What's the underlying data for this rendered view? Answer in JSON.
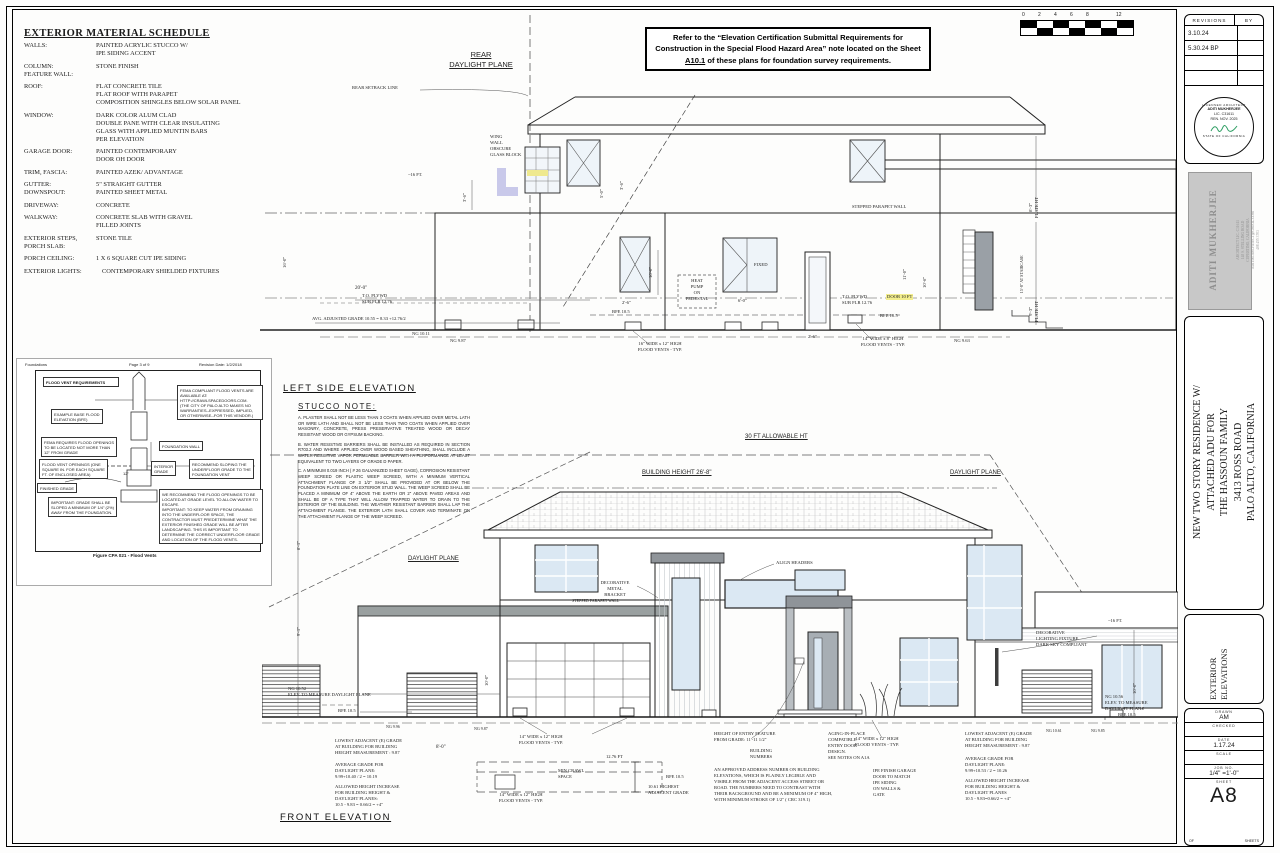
{
  "material_schedule": {
    "title": "EXTERIOR MATERIAL SCHEDULE",
    "items": [
      {
        "label": "WALLS:",
        "value": "PAINTED ACRYLIC STUCCO W/\nIPE SIDING ACCENT"
      },
      {
        "label": "COLUMN:\nFEATURE WALL:",
        "value": "STONE FINISH"
      },
      {
        "label": "ROOF:",
        "value": "FLAT CONCRETE TILE\nFLAT ROOF WITH PARAPET\nCOMPOSITION SHINGLES BELOW SOLAR PANEL"
      },
      {
        "label": "WINDOW:",
        "value": "DARK COLOR ALUM CLAD\nDOUBLE PANE WITH CLEAR INSULATING\nGLASS WITH APPLIED MUNTIN BARS\nPER ELEVATION"
      },
      {
        "label": "GARAGE DOOR:",
        "value": "PAINTED CONTEMPORARY\nDOOR OH DOOR"
      },
      {
        "label": "TRIM, FASCIA:",
        "value": "PAINTED AZEK/ ADVANTAGE"
      },
      {
        "label": "GUTTER:\nDOWNSPOUT:",
        "value": "5\" STRAIGHT GUTTER\nPAINTED SHEET METAL"
      },
      {
        "label": "DRIVEWAY:",
        "value": "CONCRETE"
      },
      {
        "label": "WALKWAY:",
        "value": "CONCRETE SLAB WITH GRAVEL\nFILLED JOINTS"
      },
      {
        "label": "EXTERIOR STEPS,\nPORCH SLAB:",
        "value": "STONE TILE"
      },
      {
        "label": "PORCH CEILING:",
        "value": "1 X 6 SQUARE CUT IPE SIDING"
      },
      {
        "label": "EXTERIOR LIGHTS:",
        "value": "CONTEMPORARY  SHIELDED FIXTURES"
      }
    ]
  },
  "flood_note_box": {
    "text_pre": "Refer to the “Elevation Certification Submittal Requirements for Construction in the Special Flood Hazard Area” note located on the Sheet",
    "sheet_ref": "A10.1",
    "text_post": "of these plans for foundation survey requirements."
  },
  "scale_bar": {
    "ticks": [
      "0",
      "2",
      "4",
      "6",
      "8",
      "12"
    ]
  },
  "left_elevation": {
    "title": "LEFT SIDE ELEVATION",
    "labels": {
      "rear_daylight_plane": "REAR\nDAYLIGHT PLANE",
      "rear_setback_line": "REAR SETBACK LINE",
      "wing_wall": "WING\nWALL\nOBSCURE\nGLASS BLOCK",
      "ht_16": "~16 FT.",
      "dim_3_6_a": "3'-6\"",
      "dim_5_0": "5'-0\"",
      "dim_3_6_b": "3'-6\"",
      "dim_16_0": "16'-0\"",
      "dim_10_0": "10'-0\"",
      "dim_20_0": "20'-0\"",
      "top_plywd_left": "T.O. PLYWD\nSUB FLR 12.76",
      "avg_grade": "AVG. ADJUSTED GRADE 10.55 = 8.33 +12.76/2",
      "ng_1011": "NG 10.11",
      "ng_987": "NG 9.87",
      "heat_pump": "HEAT\nPUMP\nON\nPEDESTAL",
      "fixed": "FIXED",
      "bfe_left": "BFE  10.5",
      "vents_16": "16\" WIDE x 12\" HIGH\nFLOOD VENTS - TYP.",
      "dim_2_6_a": "2'-6\"",
      "dim_6_0": "6'-0\"",
      "dim_2_6_b": "2'-6\"",
      "stepped_parapet": "STEPPED PARAPET WALL",
      "top_plywd_right": "T.O. PLYWD\nSUB FLR 12.76",
      "door_hl": "DOOR 10 FT",
      "bfe_right": "BFE  10.5",
      "vents_14": "14\" WIDE x 8\" HIGH\nFLOOD VENTS - TYP.",
      "ng_963": "NG 9.63",
      "dim_11_0": "11'-0\"",
      "dim_10_6": "10'-6\"",
      "dim_15_8": "15'-8\" AT STAIRCASE",
      "plate_a": "8'-3\"\nPLATE HT",
      "plate_b": "9'-3\"\nPLATE HT"
    }
  },
  "stucco_note": {
    "title": "STUCCO NOTE:",
    "para_a": "A. PLASTER SHALL NOT BE LESS THAN 3 COATS WHEN APPLIED OVER METAL LATH OR WIRE LATH AND SHALL NOT BE LESS THAN TWO COATS WHEN APPLIED OVER MASONRY, CONCRETE, PRESS PRESERVATIVE TREATED WOOD OR DECAY RESISTANT WOOD OR GYPSUM BACKING.",
    "para_b": "B. WATER RESISTIVE BARRIERS SHALL BE INSTALLED AS REQUIRED IN SECTION R703.2 AND WHERE APPLIED OVER WOOD BASED SHEATHING, SHALL INCLUDE A WATER RESISTIVE VAPOR PERMEABLE BARRIER WITH A PERFORMANCE AT LEAST EQUIVALENT TO TWO LAYERS OF GRADE D PAPER.",
    "para_c": "C. A MINIMUM 0.019 INCH ( # 26 GALVANIZED SHEET GAGE), CORROSION RESISTANT WEEP SCREED OR PLASTIC WEEP SCREED, WITH A MINIMUM VERTICAL ATTACHMENT FLANGE OF 3 1/2\" SHALL BE PROVIDED AT OR BELOW THE FOUNDATION PLATE LINE ON EXTERIOR STUD WALL. THE WEEP SCREED SHALL BE PLACED A MINIMUM OF 4\" ABOVE THE EARTH OR 2\" ABOVE PAVED AREAS AND SHALL BE OF A TYPE THAT WILL ALLOW TRAPPED WATER TO DRAIN TO THE EXTERIOR OF THE BUILDING. THE WEATHER RESISTANT BARRIER SHALL LAP THE ATTACHMENT FLANGE. THE EXTERIOR LATH SHALL COVER AND TERMINATE ON THE ATTACHMENT FLANGE OF THE WEEP SCREED."
  },
  "flood_figure": {
    "header_left": "Foundations",
    "header_center": "Page 3 of 9",
    "header_right": "Revision Date: 1/2/2018",
    "title": "FLOOD VENT REQUIREMENTS",
    "bfe_example": "EXAMPLE BASE FLOOD\nELEVATION (BFE)",
    "fema_vendor": "FEMA COMPLIANT FLOOD VENTS ARE\nAVAILABLE AT:\nHTTP://CRAWLSPACEDOORS.COM.\n(THE CITY OF PALO ALTO MAKES NO\nWARRANTIES--EXPRESSED, IMPLIED,\nOR OTHERWISE--FOR THIS VENDOR.)",
    "fema_req": "FEMA REQUIRES FLOOD OPENINGS\nTO BE LOCATED NOT MORE THAN\n12\" FROM GRADE",
    "vent_openings": "FLOOD VENT OPENINGS (ONE\nSQUARE IN. FOR EACH SQUARE\nFT. OF ENCLOSED AREA)",
    "foundation_wall": "FOUNDATION WALL",
    "interior_grade": "INTERIOR\nGRADE",
    "recommend_slope": "RECOMMEND SLOPING THE\nUNDERFLOOR GRADE TO THE\nFOUNDATION VENT",
    "finished_grade": "FINISHED GRADE",
    "important_grade": "IMPORTANT: GRADE SHALL BE\nSLOPED A MINIMUM OF 1/4\" (2%)\nAWAY FROM THE FOUNDATION.",
    "recommend_openings": "WE RECOMMEND THE FLOOD OPENINGS TO BE\nLOCATED AT GRADE LEVEL TO ALLOW WATER TO\nESCAPE.\nIMPORTANT: TO KEEP WATER FROM DRAINING\nINTO THE UNDERFLOOR SPACE, THE\nCONTRACTOR MUST PREDETERMINE WHAT THE\nEXTERIOR FINISHED GRADE WILL BE AFTER\nLANDSCAPING. THIS IS IMPORTANT TO\nDETERMINE THE CORRECT UNDERFLOOR GRADE\nAND LOCATION OF THE FLOOD VENTS.",
    "dim_12": "12\"",
    "caption": "Figure CPA 021 - Flood Vents"
  },
  "front_elevation": {
    "title": "FRONT ELEVATION",
    "labels": {
      "allowable_ht": "30 FT ALLOWABLE HT",
      "daylight_plane_right": "DAYLIGHT PLANE",
      "daylight_plane_left": "DAYLIGHT PLANE",
      "building_height": "BUILDING HEIGHT 26'-8\"",
      "align_headers": "ALIGN HEADERS",
      "decorative_bracket": "DECORATIVE\nMETAL BRACKET",
      "stepped_parapet": "STEPPED PARAPET WALL",
      "decorative_light": "DECORATIVE\nLIGHTING FIXTURE\nDARK SKY COMPLIANT",
      "ht_16": "~16 FT.",
      "ng_1052": "NG 10.52\nELEV. TO MEASURE DAYLIGHT PLANE",
      "bfe_left": "BFE  10.5",
      "ng_996": "NG 9.96",
      "ng_987": "NG 9.87",
      "lowest_left": "LOWEST ADJACENT (E) GRADE\nAT BUILDING FOR BUILDING\nHEIGHT MEASUREMENT : 9.87",
      "avg_left": "AVERAGE GRADE FOR\nDAYLIGHT PLANE:\n9.99+10.40 / 2 = 10.19",
      "allowed_left": "ALLOWED HEIGHT INCREASE\nFOR BUILDING HEIGHT &\nDAYLIGHT PLANES:\n10.5 - 9.83 = 0.66/2 = +4\"",
      "dim_8_0": "8'-0\"",
      "vents_garage": "14\" WIDE x 12\" HIGH\nFLOOD VENTS - TYP.",
      "min_crawl": "MIN CRAWL\nSPACE",
      "dim_1276": "12.76 FT",
      "bfe_crawl": "BFE  10.5",
      "highest_grade": "10.61 HIGHEST\nADJACENT GRADE",
      "vents_crawl": "14\" WIDE x 12\" HIGH\nFLOOD VENTS - TYP.",
      "entry_height": "HEIGHT OF ENTRY FEATURE\nFROM GRADE: 11'-11 1/2\"",
      "building_numbers": "BUILDING\nNUMBERS",
      "address_note": "AN APPROVED ADDRESS NUMBER ON BUILDING\nELEVATIONS, WHICH IS PLAINLY LEGIBLE AND\nVISIBLE FROM THE ADJACENT ACCESS STREET OR\nROAD. THE NUMBERS NEED TO CONTRAST WITH\nTHEIR BACKGROUND AND BE A MINIMUM OF 4\" HIGH,\nWITH MINIMUM STROKE OF 1/2\" ( CRC 319.1)",
      "aging_in_place": "AGING-IN-PLACE\nCOMPATIBLE\nENTRY DOOR\nDESIGN.\nSEE NOTES ON A1A",
      "vents_entry": "14\" WIDE x 12\" HIGH\nFLOOD VENTS - TYP.",
      "ipe_garage": "IPE FINISH GARAGE\nDOOR TO MATCH\nIPE SIDING\nON WALLS &\nGATE",
      "lowest_right": "LOWEST ADJACENT (E) GRADE\nAT BUILDING FOR BUILDING\nHEIGHT MEASUREMENT : 9.87",
      "avg_right": "AVERAGE GRADE FOR\nDAYLIGHT PLANE:\n9.99+10.53 / 2 = 10.26",
      "allowed_right": "ALLOWED HEIGHT INCREASE\nFOR BUILDING HEIGHT &\nDAYLIGHT PLANES\n10.5 - 9.83=0.66/2 = +4\"",
      "ng_1061": "NG 10.61",
      "ng_985": "NG 9.85",
      "ng_1056": "NG 10.56\nELEV. TO MEASURE\nDAYLIGHT PLANE",
      "bfe_right": "BFE  10.5",
      "dim_9_3": "9'-3\"",
      "dim_8_3": "8'-3\"",
      "dim_10_0": "10'-0\"",
      "dim_10_0b": "10'-0\""
    }
  },
  "title_block": {
    "revisions": {
      "header_col1": "REVISIONS",
      "header_col2": "BY",
      "rows": [
        "3.10.24",
        "5.30.24 BP",
        "",
        ""
      ]
    },
    "stamp": {
      "arc_top": "LICENSED ARCHITECT",
      "name": "ADITI MUKHERJEE",
      "license": "LIC. C31611",
      "renewal": "REN. NOV. 2025",
      "arc_bottom": "STATE OF CALIFORNIA"
    },
    "architect_info": {
      "name": "ADITI MUKHERJEE",
      "lines": "ARCHITECT LIC. C31611\n148 S. STELLING ROAD\nCUPERTINO, CALIFORNIA\nADITIM.ARCHITECT@GMAIL.COM\n408 455 3703"
    },
    "project": "NEW  TWO STORY RESIDENCE W/\nATTACHED ADU FOR\nTHE HASSOUN FAMILY\n3413 ROSS ROAD\nPALO ALTO, CALIFORNIA",
    "sheet_title": "EXTERIOR\nELEVATIONS",
    "fields": [
      {
        "label": "DRAWN",
        "value": "AM"
      },
      {
        "label": "CHECKED",
        "value": ""
      },
      {
        "label": "DATE",
        "value": "1.17.24"
      },
      {
        "label": "SCALE",
        "value": ""
      },
      {
        "label": "JOB NO.",
        "value": "1/4\" =1'-0\""
      },
      {
        "label": "SHEET",
        "value": ""
      }
    ],
    "sheet_number": "A8",
    "of_label": "OF",
    "sheets_label": "SHEETS"
  }
}
